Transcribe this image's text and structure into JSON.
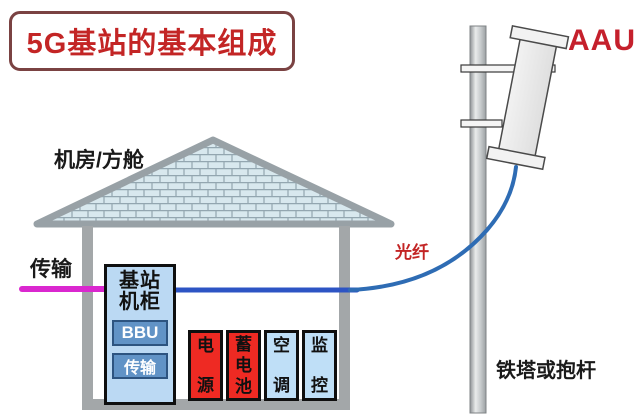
{
  "title": "5G基站的基本组成",
  "aau_label": "AAU",
  "labels": {
    "room": "机房/方舱",
    "transmission": "传输",
    "fiber": "光纤",
    "tower": "铁塔或抱杆"
  },
  "cabinet": {
    "name_line1": "基站",
    "name_line2": "机柜",
    "modules": [
      {
        "label": "BBU"
      },
      {
        "label": "传输"
      }
    ]
  },
  "equipment": [
    {
      "label": "电源",
      "chars": [
        "电",
        "源"
      ],
      "variant": "red"
    },
    {
      "label": "蓄电池",
      "chars": [
        "蓄",
        "电",
        "池"
      ],
      "variant": "red"
    },
    {
      "label": "空调",
      "chars": [
        "空",
        "调"
      ],
      "variant": "blue"
    },
    {
      "label": "监控",
      "chars": [
        "监",
        "控"
      ],
      "variant": "blue"
    }
  ],
  "colors": {
    "accent_red": "#c32525",
    "box_red": "#ee2a23",
    "box_blue": "#bfdff7",
    "cabinet_blue": "#bbd9f3",
    "module_blue": "#6193c6",
    "transmission_magenta": "#da27cf",
    "fiber_blue": "#2e6cb4",
    "structure_gray": "#a3a7a9"
  }
}
